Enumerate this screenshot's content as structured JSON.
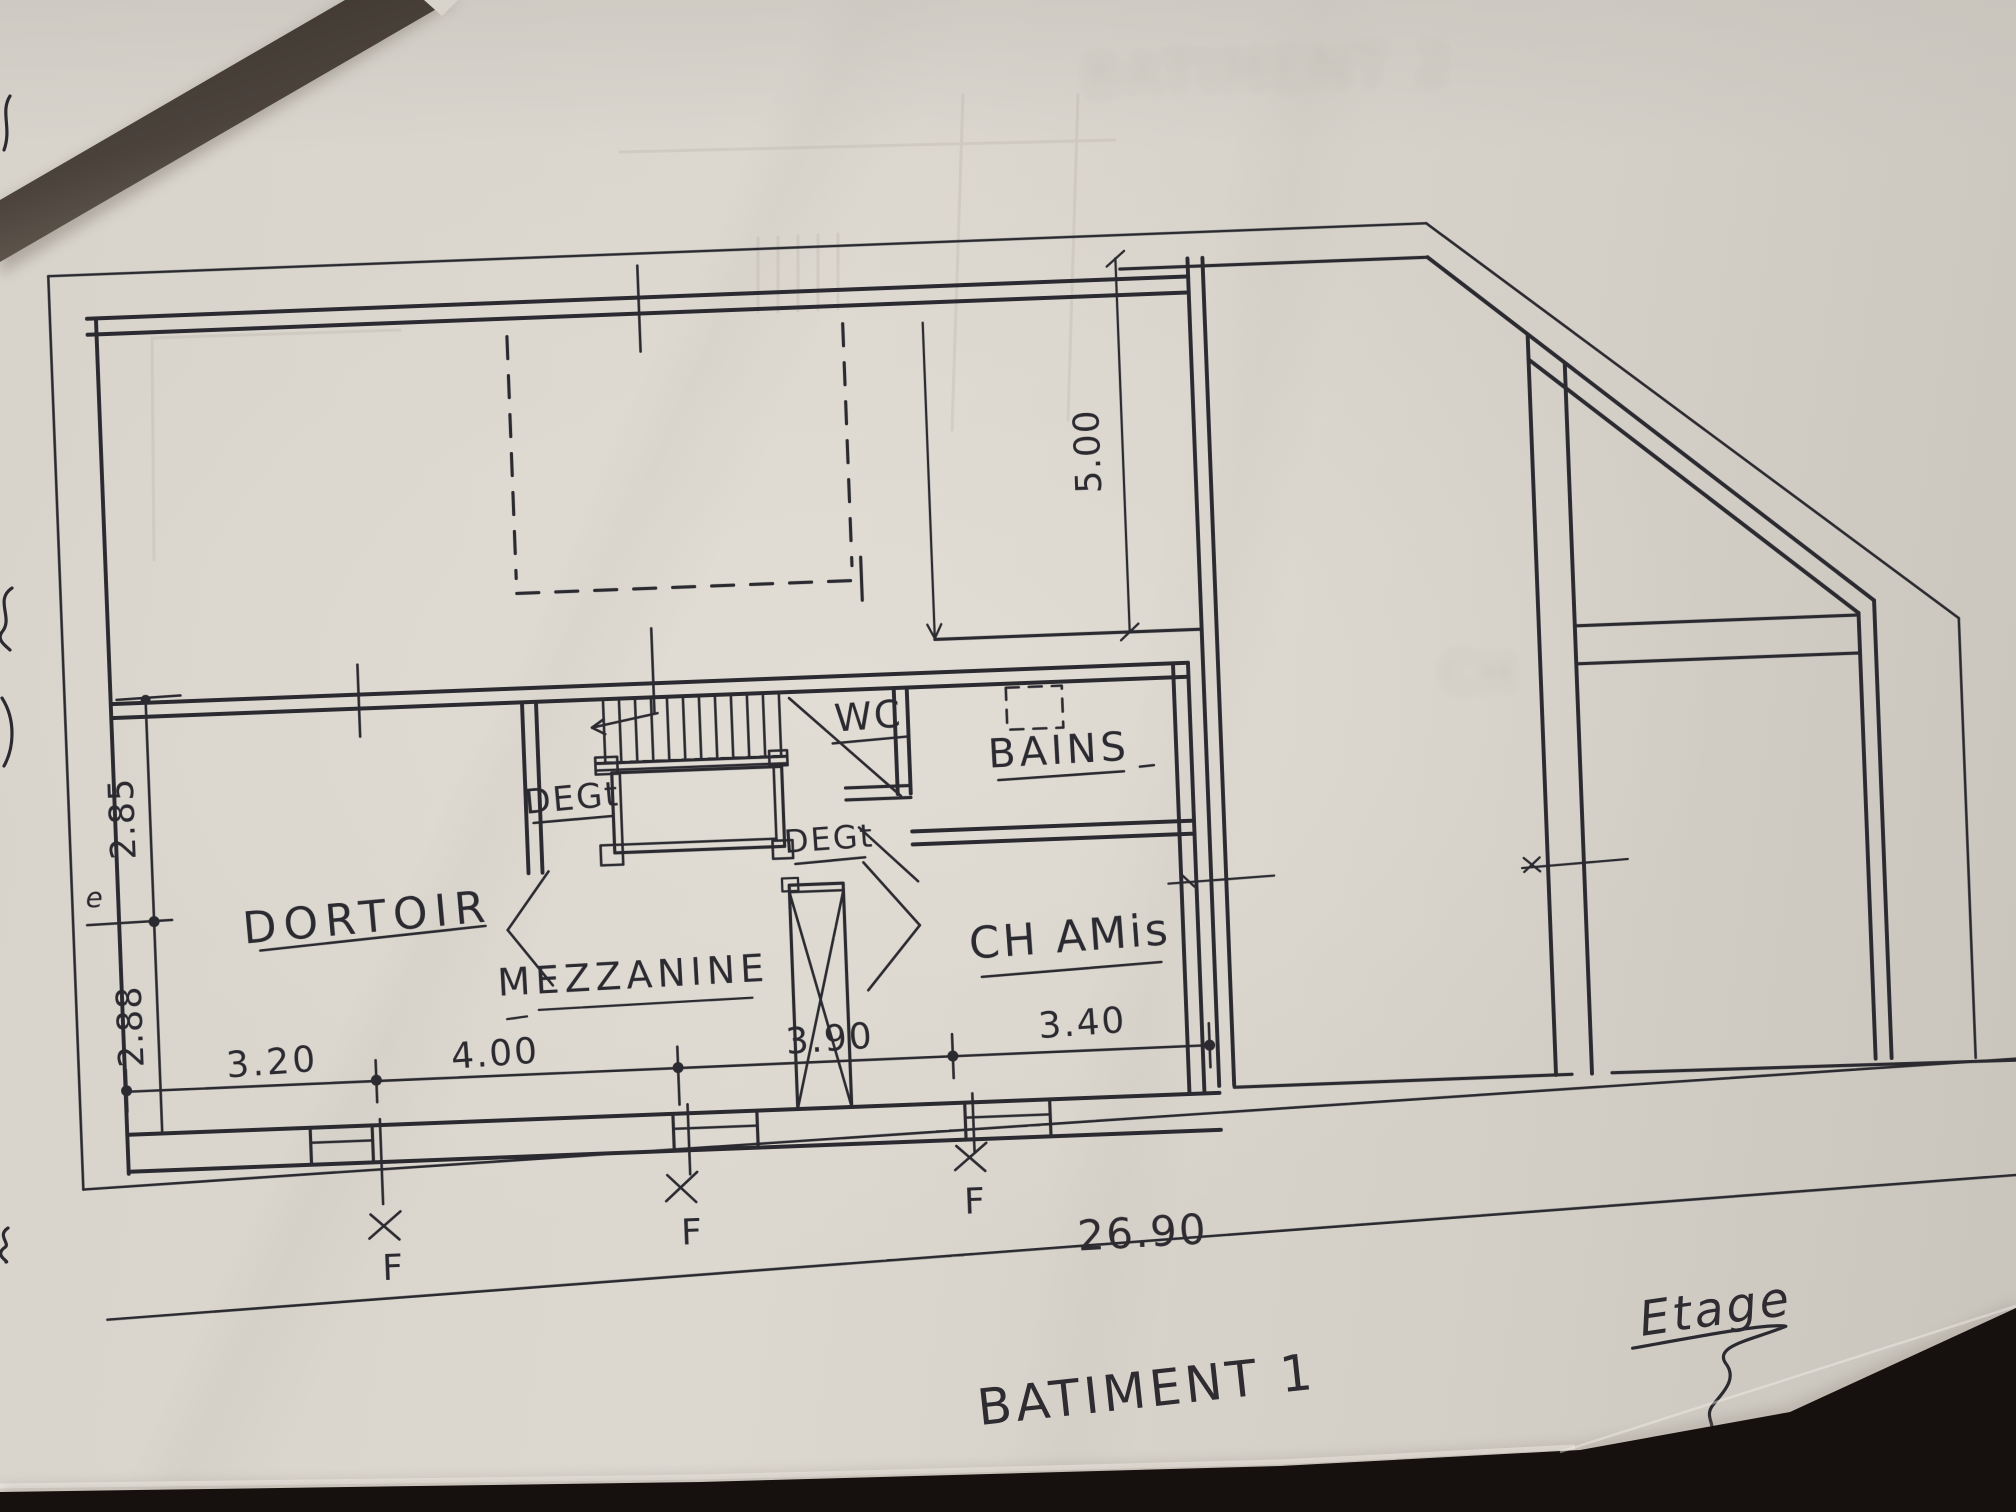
{
  "photo": {
    "paper_color": "#d8d4cc",
    "ink_color": "#2b2a30",
    "corner_shadow_color": "#3f3833",
    "table_color": "#16110e"
  },
  "plan": {
    "rooms": {
      "dortoir": "DORTOIR",
      "mezzanine": "MEZZANINE",
      "ch_amis": "CH AMis",
      "wc": "WC",
      "bains": "BAINS",
      "degagement_1": "DEGt",
      "degagement_2": "DEGt"
    },
    "dimensions": {
      "left_upper": "2.85",
      "left_lower": "2.88",
      "bottom_1": "3.20",
      "bottom_2": "4.00",
      "bottom_3": "3.90",
      "bottom_4": "3.40",
      "overall_width": "26.90",
      "courtyard_depth": "5.00"
    },
    "window_marks": {
      "f1": "F",
      "f2": "F",
      "f3": "F"
    },
    "margin_mark": "e",
    "titles": {
      "building": "BATIMENT 1",
      "floor": "Etage",
      "scale": "1/10"
    },
    "bleed_through": {
      "top_title": "BATIMENT 2",
      "room": "CH"
    }
  }
}
